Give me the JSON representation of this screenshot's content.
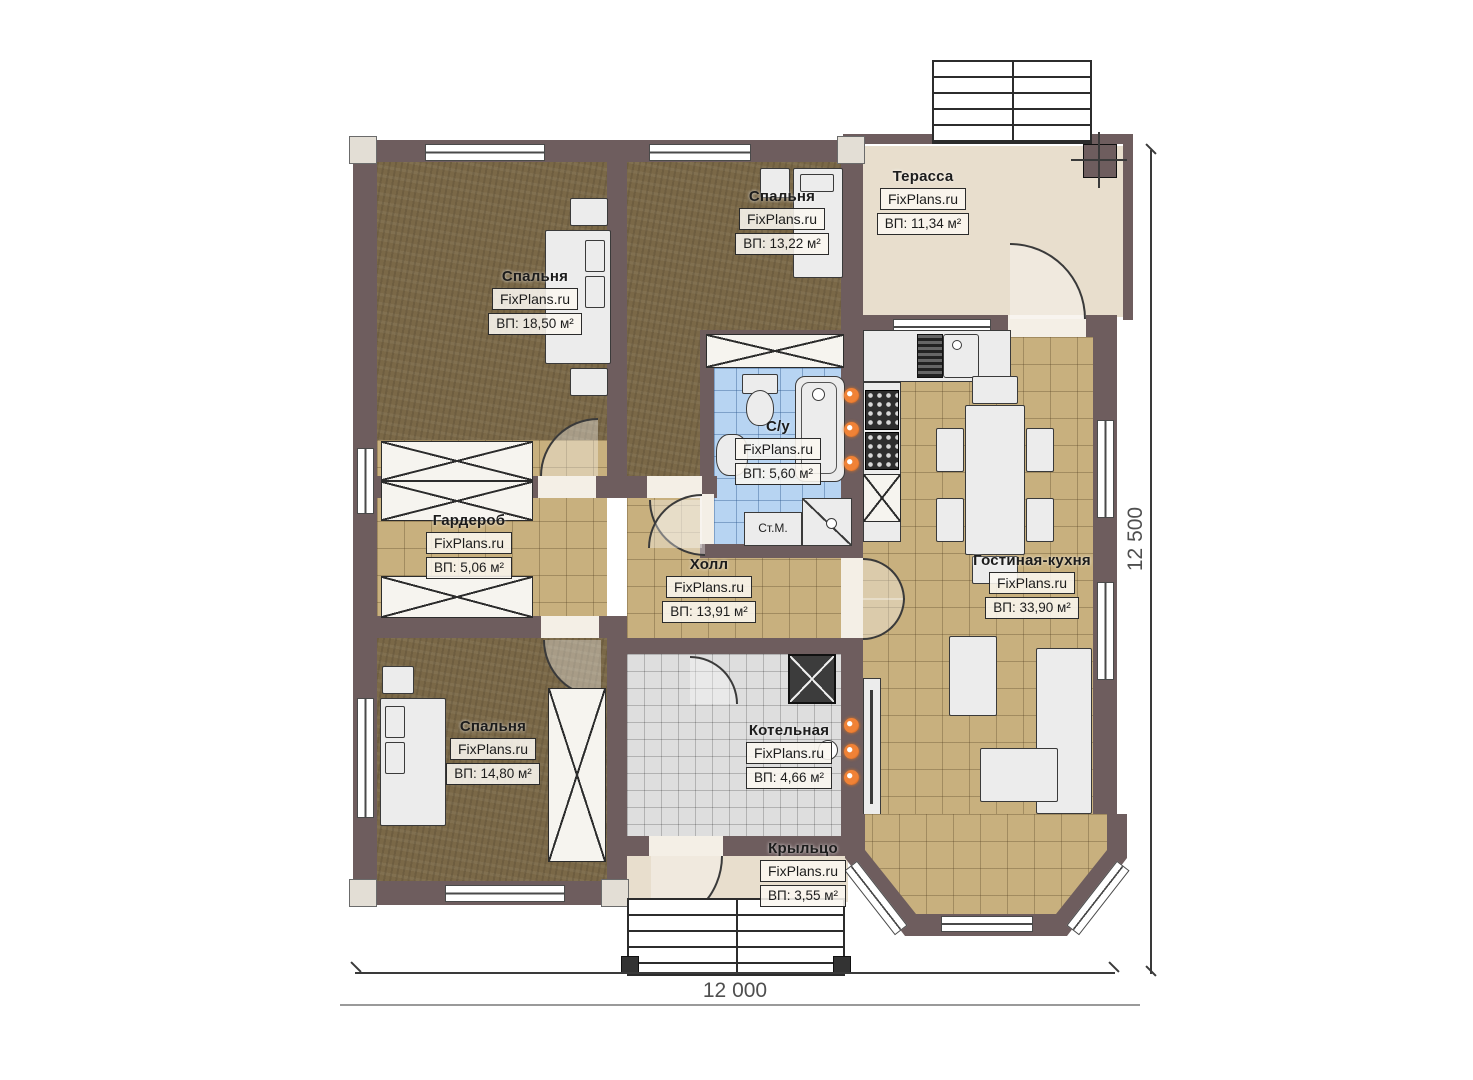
{
  "brand": "FixPlans.ru",
  "rooms": [
    {
      "id": "bedroom-1",
      "name": "Спальня",
      "area": "ВП: 18,50 м²"
    },
    {
      "id": "bedroom-2",
      "name": "Спальня",
      "area": "ВП: 13,22 м²"
    },
    {
      "id": "terrace",
      "name": "Терасса",
      "area": "ВП: 11,34 м²"
    },
    {
      "id": "bathroom",
      "name": "С/у",
      "area": "ВП: 5,60 м²"
    },
    {
      "id": "wardrobe",
      "name": "Гардероб",
      "area": "ВП: 5,06 м²"
    },
    {
      "id": "hall",
      "name": "Холл",
      "area": "ВП: 13,91 м²"
    },
    {
      "id": "living-kitchen",
      "name": "Гостиная-кухня",
      "area": "ВП: 33,90 м²"
    },
    {
      "id": "bedroom-3",
      "name": "Спальня",
      "area": "ВП: 14,80 м²"
    },
    {
      "id": "boiler-room",
      "name": "Котельная",
      "area": "ВП: 4,66 м²"
    },
    {
      "id": "porch",
      "name": "Крыльцо",
      "area": "ВП: 3,55 м²"
    }
  ],
  "labels": {
    "washing_machine": "Ст.М."
  },
  "dimensions": {
    "width": "12 000",
    "height": "12 500"
  },
  "colors": {
    "wall": "#6e5d5e",
    "wood_floor": "#7a6847",
    "tile_floor": "#c8b07e",
    "bath_tile": "#b7d4f2",
    "boiler_tile": "#dedede",
    "terrace_floor": "#e8decd",
    "radiator_accent": "#f08236"
  }
}
